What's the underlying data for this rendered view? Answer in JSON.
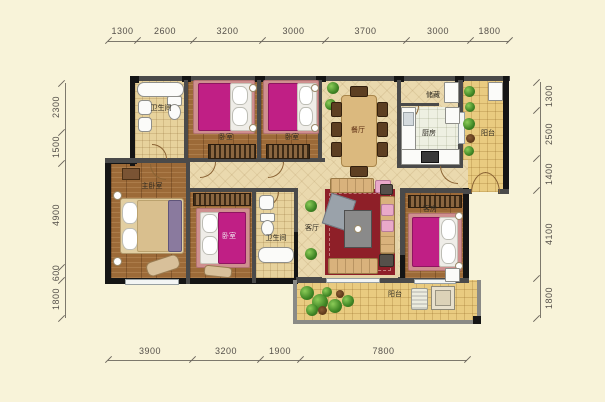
{
  "plan_title": "apartment-floor-plan",
  "dims": {
    "top": [
      "1300",
      "2600",
      "3200",
      "3000",
      "3700",
      "3000",
      "1800"
    ],
    "bottom": [
      "3900",
      "3200",
      "1900",
      "7800"
    ],
    "left": [
      "2300",
      "1500",
      "4900",
      "600",
      "1800"
    ],
    "right": [
      "1300",
      "2500",
      "1400",
      "4100",
      "1800"
    ]
  },
  "rooms": {
    "bath_top": "卫生间",
    "bedroom_1": "卧室",
    "bedroom_2": "卧室",
    "dining": "餐厅",
    "storage": "储藏",
    "kitchen": "厨房",
    "balcony_right": "阳台",
    "master_bedroom": "主卧室",
    "bedroom_3": "卧室",
    "bath_mid": "卫生间",
    "living": "客厅",
    "guest_room": "客房",
    "balcony_bottom": "阳台"
  },
  "colors": {
    "background": "#f8f3d9",
    "wall_dark": "#151515",
    "wall_gray": "#4a4a4a",
    "wood_floor": "#9c6a38",
    "tile_floor": "#ead9ae",
    "balcony_floor": "#e9cb80",
    "kitchen_floor": "#eef0e2",
    "bed_magenta": "#c01f85",
    "bed_rug_pink": "#cf8f8f",
    "carpet_red": "#8e1f28",
    "plant_green": "#3f8524",
    "dim_text": "#55504a"
  }
}
